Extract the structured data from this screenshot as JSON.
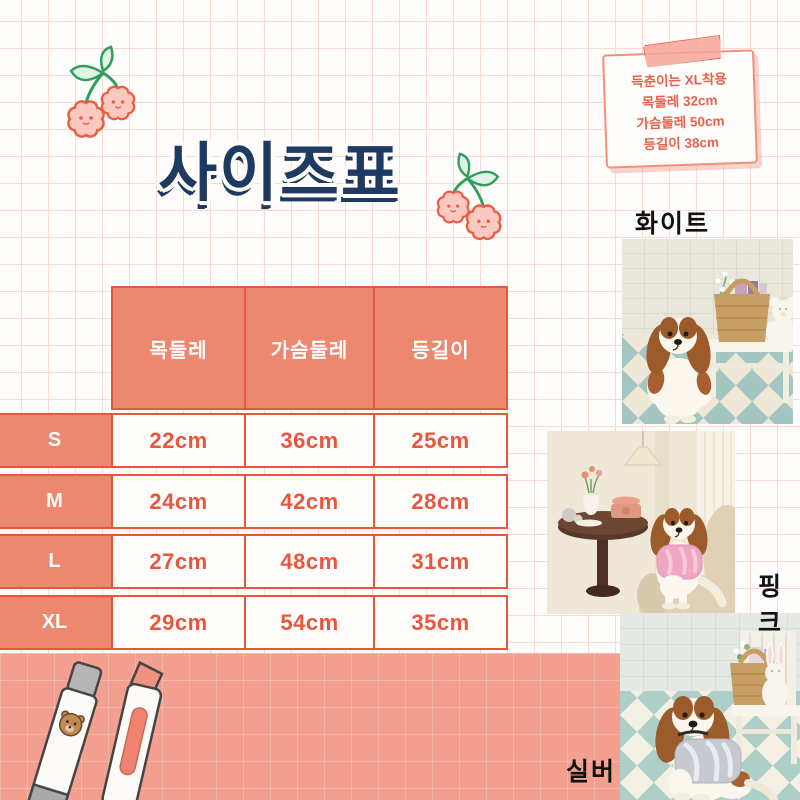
{
  "page_title": "사이즈표",
  "note": {
    "line1": "득춘이는 XL착용",
    "line2": "목둘레 32cm",
    "line3": "가슴둘레 50cm",
    "line4": "등길이 38cm"
  },
  "size_table": {
    "columns": [
      "목둘레",
      "가슴둘레",
      "등길이"
    ],
    "rows": [
      {
        "size": "S",
        "values": [
          "22cm",
          "36cm",
          "25cm"
        ]
      },
      {
        "size": "M",
        "values": [
          "24cm",
          "42cm",
          "28cm"
        ]
      },
      {
        "size": "L",
        "values": [
          "27cm",
          "48cm",
          "31cm"
        ]
      },
      {
        "size": "XL",
        "values": [
          "29cm",
          "54cm",
          "35cm"
        ]
      }
    ]
  },
  "photo_labels": {
    "white": "화이트",
    "pink": "핑크",
    "silver": "실버"
  },
  "decorations": {
    "cherry_icon": "cherry-doodle",
    "tape_icon": "washi-tape",
    "pen_icon": "pen-with-bear",
    "highlighter_icon": "highlighter"
  },
  "colors": {
    "accent": "#E8573D",
    "cell_fill": "#EC8870",
    "band": "#F3A091",
    "title": "#1F3A60",
    "grid_line": "#FADAD3"
  }
}
